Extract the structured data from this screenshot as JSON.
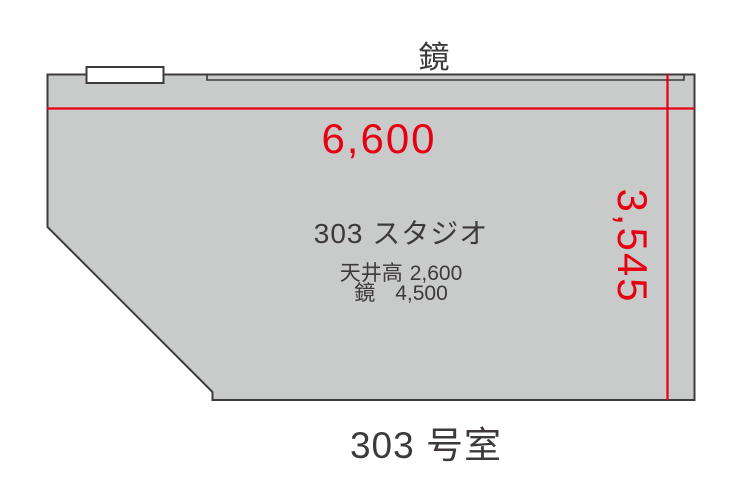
{
  "floor_plan": {
    "wall_mirror_label": "鏡",
    "dimensions": {
      "width_mm": "6,600",
      "depth_mm": "3,545"
    },
    "room": {
      "name": "303 スタジオ",
      "specs": [
        {
          "label": "天井高",
          "value": "2,600"
        },
        {
          "label": "鏡",
          "value": "4,500"
        }
      ]
    },
    "caption": "303 号室",
    "colors": {
      "room_fill": "#c9caca",
      "outline": "#3e3a39",
      "dimension_red": "#e60012",
      "text": "#3e3a39",
      "background": "#ffffff"
    }
  }
}
